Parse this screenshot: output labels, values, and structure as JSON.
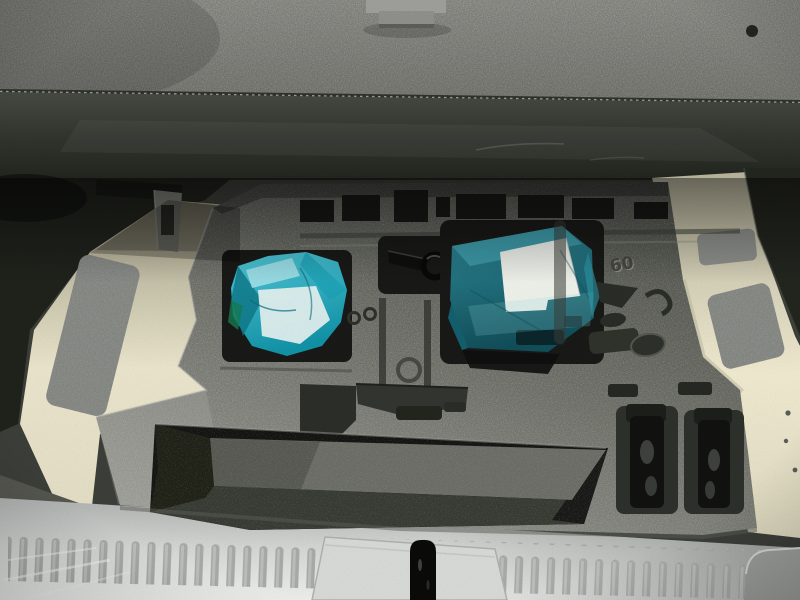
{
  "scene": {
    "title": "Car trunk cargo area with floor panel lifted showing foam tool storage tray",
    "foam_stamp": "60"
  },
  "colors": {
    "carpet_top": "#90918b",
    "carpet_bottom": "#797a74",
    "band_top": "#474a42",
    "band_bottom": "#22241e",
    "trim_dark": "#20221c",
    "bracket_gray": "#75776f",
    "cream_left_top": "#a39f88",
    "cream_left_bottom": "#e9e4cb",
    "cream_right_top": "#b5b19a",
    "cream_right_bottom": "#eee9cf",
    "felt": "#8f918d",
    "foam_top": "#5a5c55",
    "foam_mid": "#787a72",
    "foam_bottom": "#a4a69f",
    "recess_dark": "#191a18",
    "compartment_wall": "#6b6d66",
    "compartment_floor": "#383a34",
    "teal_light": "#52c8d9",
    "teal_dark": "#1292a6",
    "teal_box_light": "#2f8b9a",
    "teal_box_dark": "#124e59",
    "white_label": "#edefe9",
    "white_content": "#e6f0ef",
    "green_tint": "#157a52",
    "hook_black": "#0a0a09",
    "hook_yellow": "#c7b53b",
    "sill_top": "#aeb0af",
    "sill_mid": "#d4d6d4",
    "sill_bottom": "#eceeec",
    "sill_rib": "#a8aaa8",
    "latch_plate": "#d7d9d7",
    "latch_black": "#0b0b0a",
    "clip_gray": "#9e9e9a"
  }
}
